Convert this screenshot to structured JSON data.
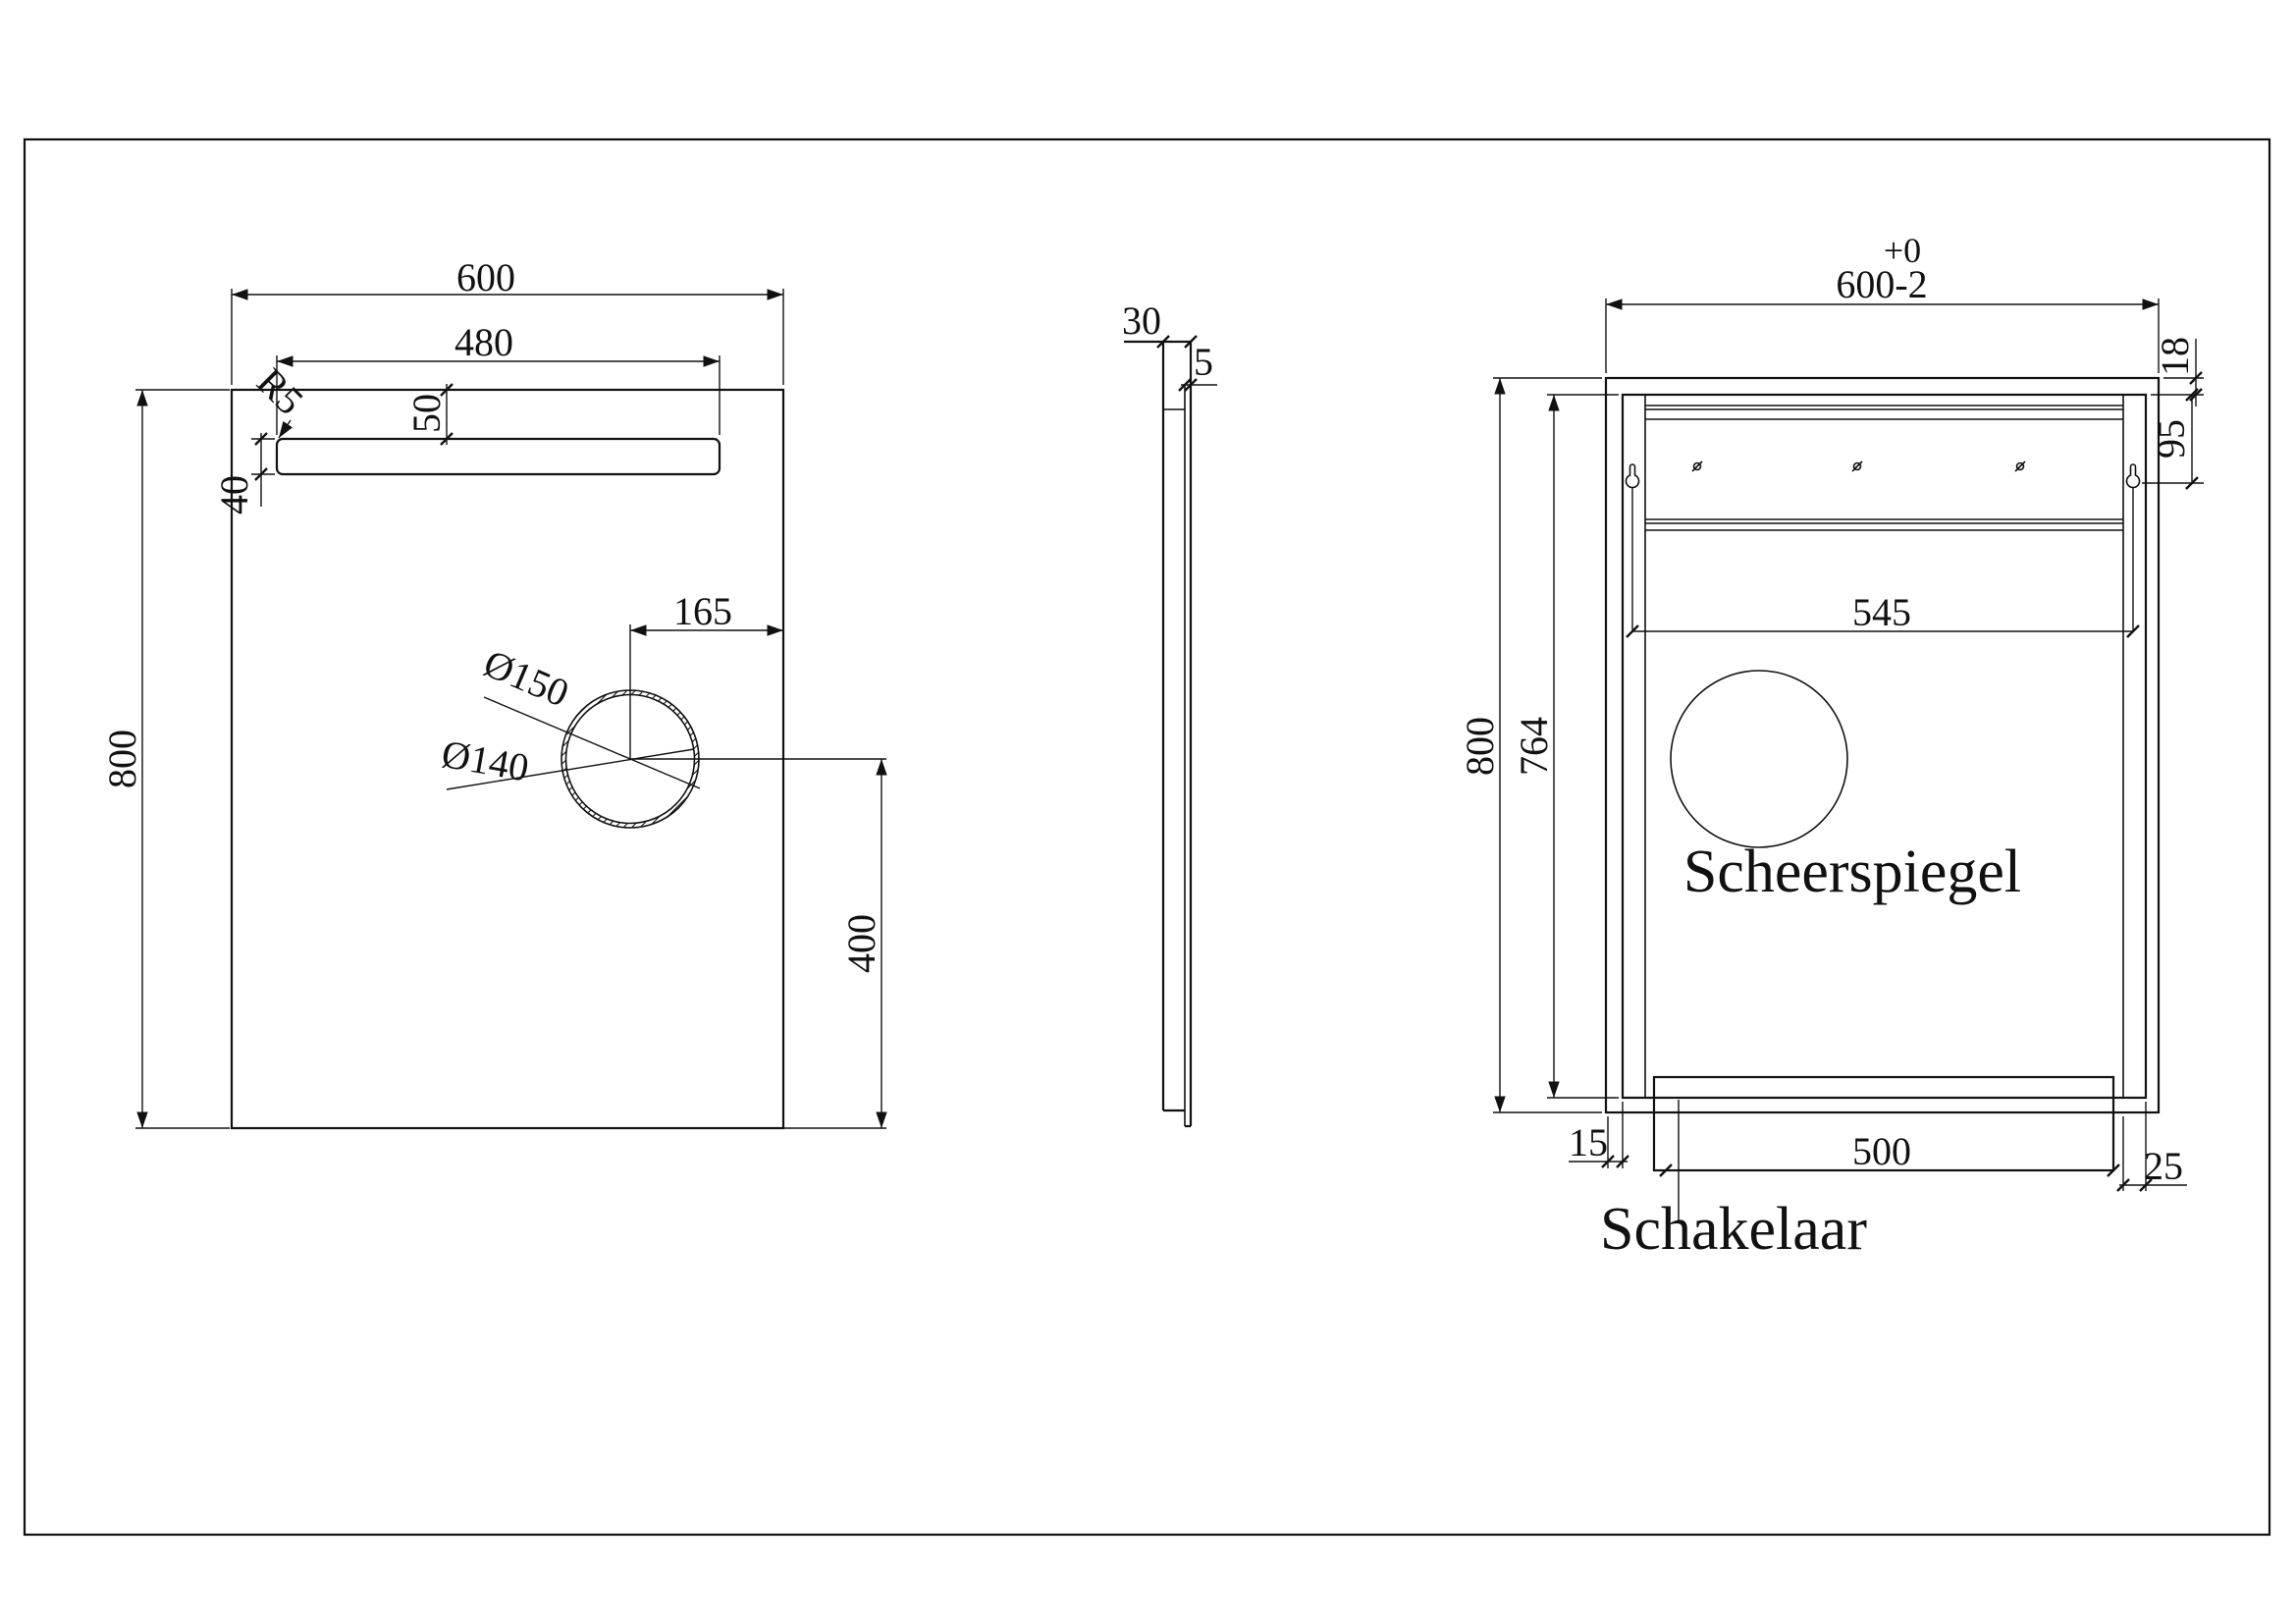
{
  "drawing": {
    "front": {
      "width": "600",
      "strip_width": "480",
      "strip_offset": "50",
      "strip_height": "40",
      "corner_radius": "R5",
      "height": "800",
      "hole_offset_right": "165",
      "hole_outer": "Ø150",
      "hole_inner": "Ø140",
      "hole_offset_bottom": "400"
    },
    "side": {
      "depth": "30",
      "glass_thickness": "5"
    },
    "back": {
      "tolerance_top": "+0",
      "width_tolerance": "600-2",
      "inset_top": "18",
      "hanger_offset": "95",
      "height": "800",
      "board_height": "764",
      "hanger_spacing": "545",
      "inset_left": "15",
      "switch_width": "500",
      "inset_right": "25",
      "label_mirror": "Scheerspiegel",
      "label_switch": "Schakelaar"
    }
  }
}
